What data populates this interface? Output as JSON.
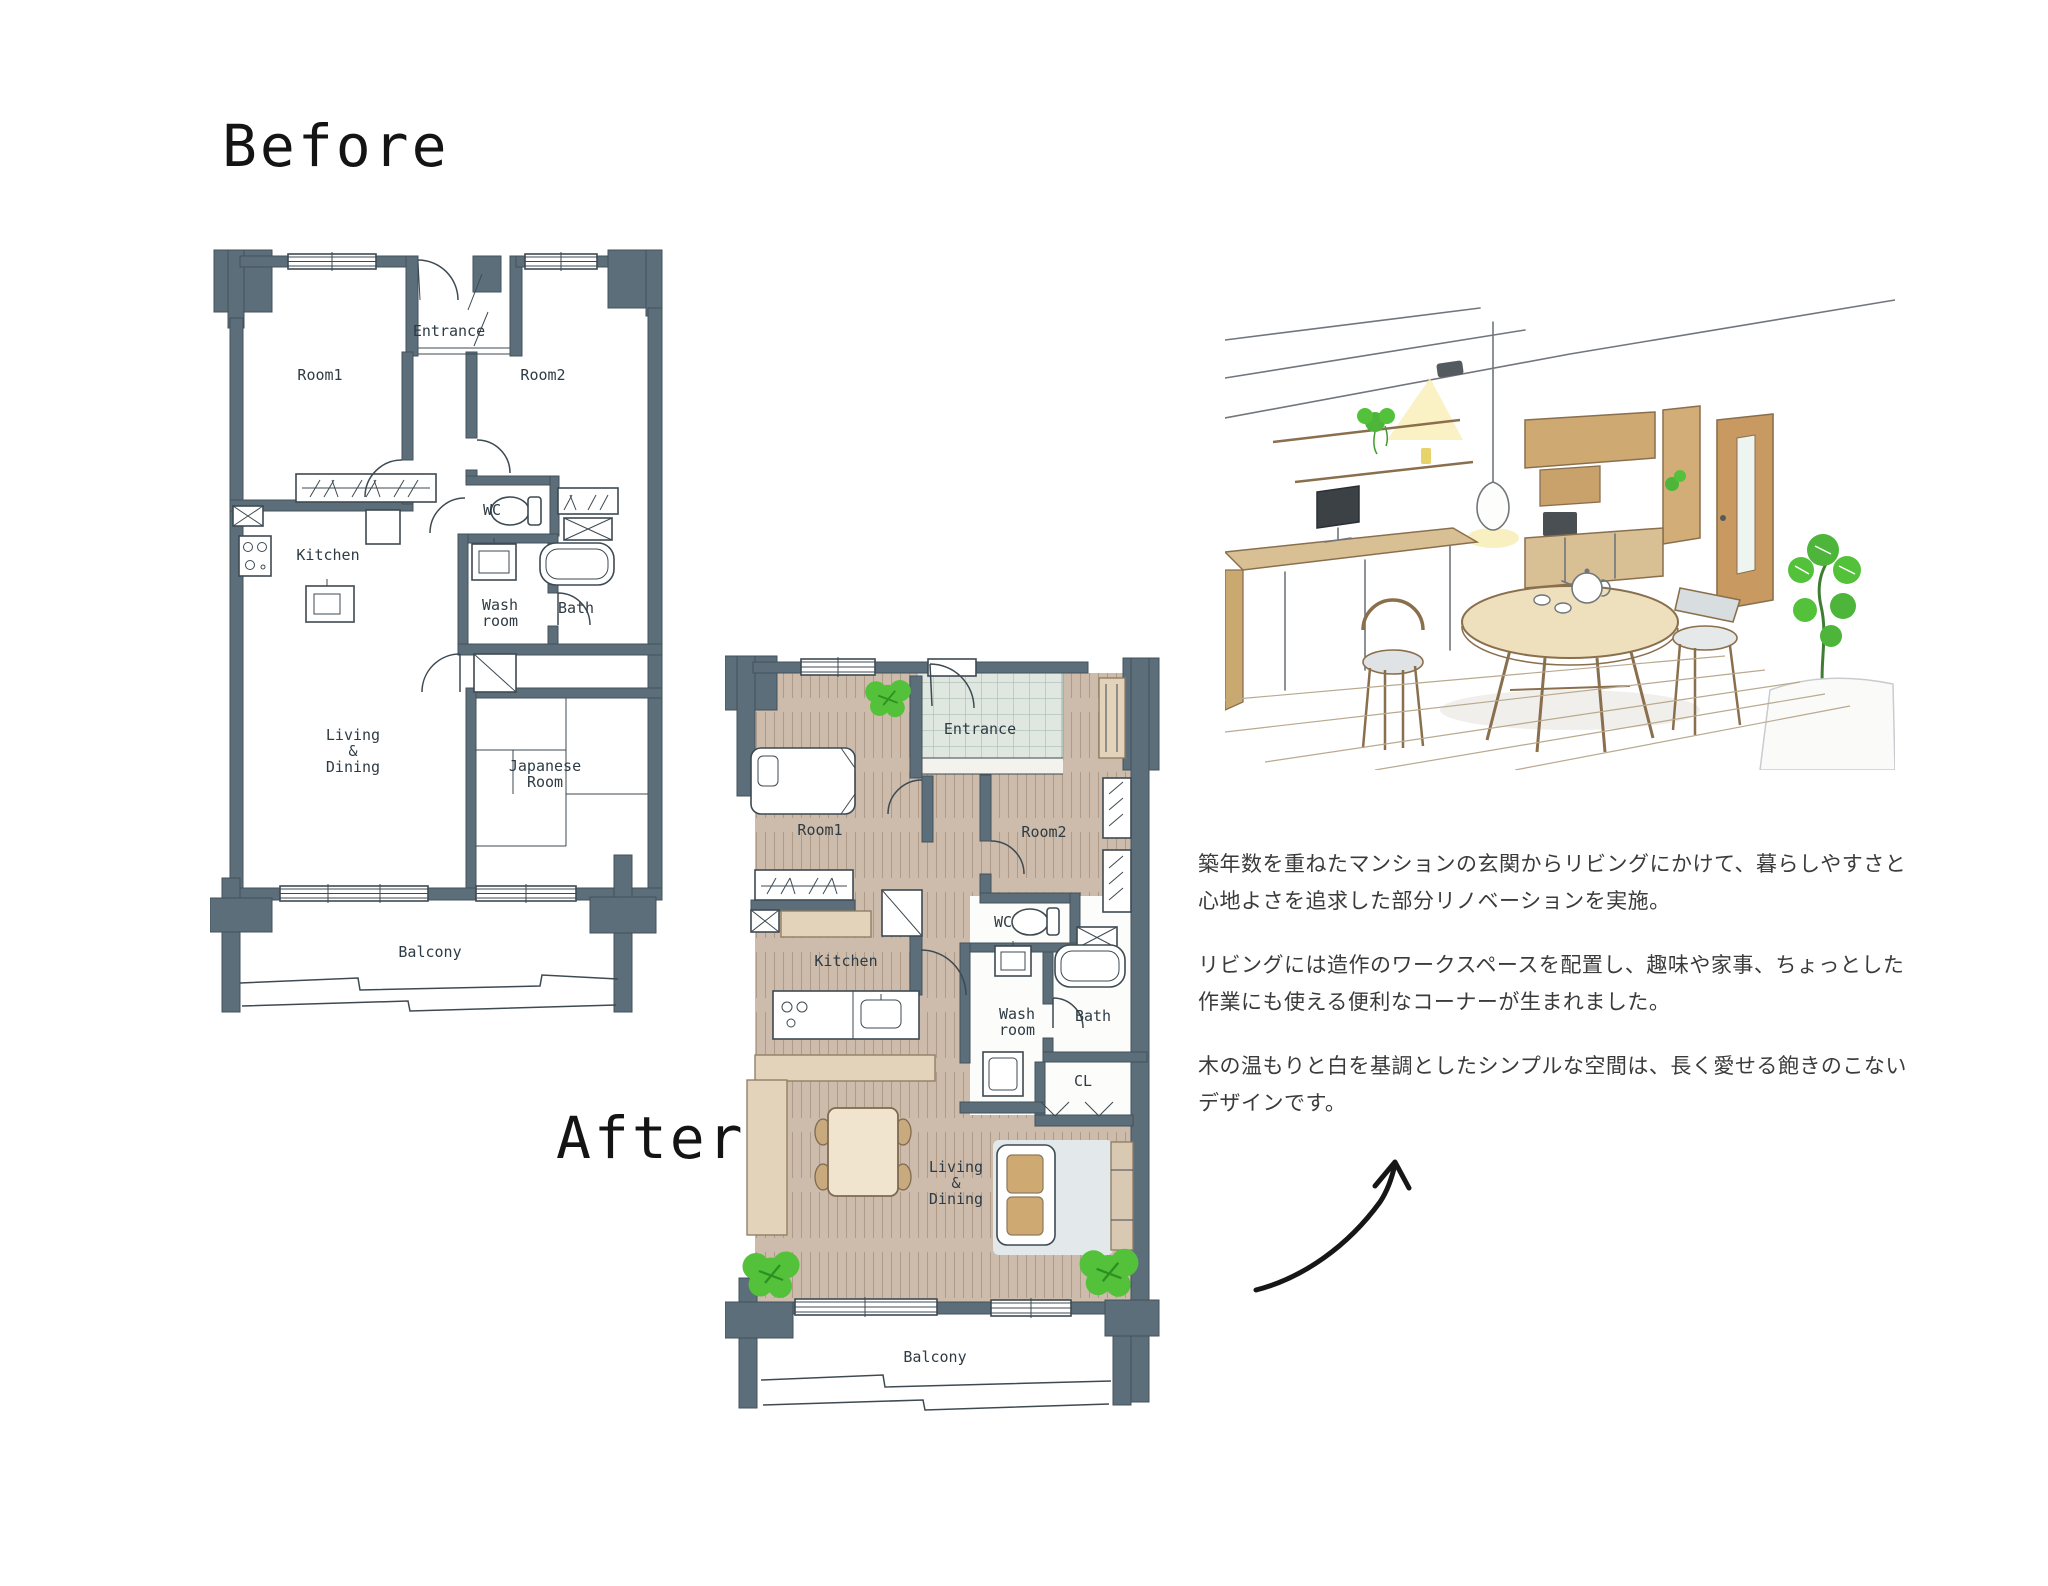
{
  "titles": {
    "before": "Before",
    "after": "After"
  },
  "before_plan": {
    "labels": {
      "room1": "Room1",
      "entrance": "Entrance",
      "room2": "Room2",
      "kitchen": "Kitchen",
      "wc": "WC",
      "washroom": "Wash\nroom",
      "bath": "Bath",
      "living": "Living\n&\nDining",
      "japanese_room": "Japanese\nRoom",
      "balcony": "Balcony"
    }
  },
  "after_plan": {
    "labels": {
      "room1": "Room1",
      "entrance": "Entrance",
      "room2": "Room2",
      "kitchen": "Kitchen",
      "wc": "WC",
      "washroom": "Wash\nroom",
      "bath": "Bath",
      "cl": "CL",
      "living": "Living\n&\nDining",
      "balcony": "Balcony"
    }
  },
  "description": {
    "p1": "築年数を重ねたマンションの玄関からリビングにかけて、暮らしやすさと心地よさを追求した部分リノベーションを実施。",
    "p2": "リビングには造作のワークスペースを配置し、趣味や家事、ちょっとした作業にも使える便利なコーナーが生まれました。",
    "p3": "木の温もりと白を基調としたシンプルな空間は、長く愛せる飽きのこないデザインです。"
  },
  "colors": {
    "wall": "#5b6e7a",
    "wood_floor": "#cdbcab",
    "entrance_tile": "#dfe7e0",
    "plant_green": "#54c13a",
    "counter_tan": "#e2d3ba",
    "ink": "#3d4a52"
  }
}
